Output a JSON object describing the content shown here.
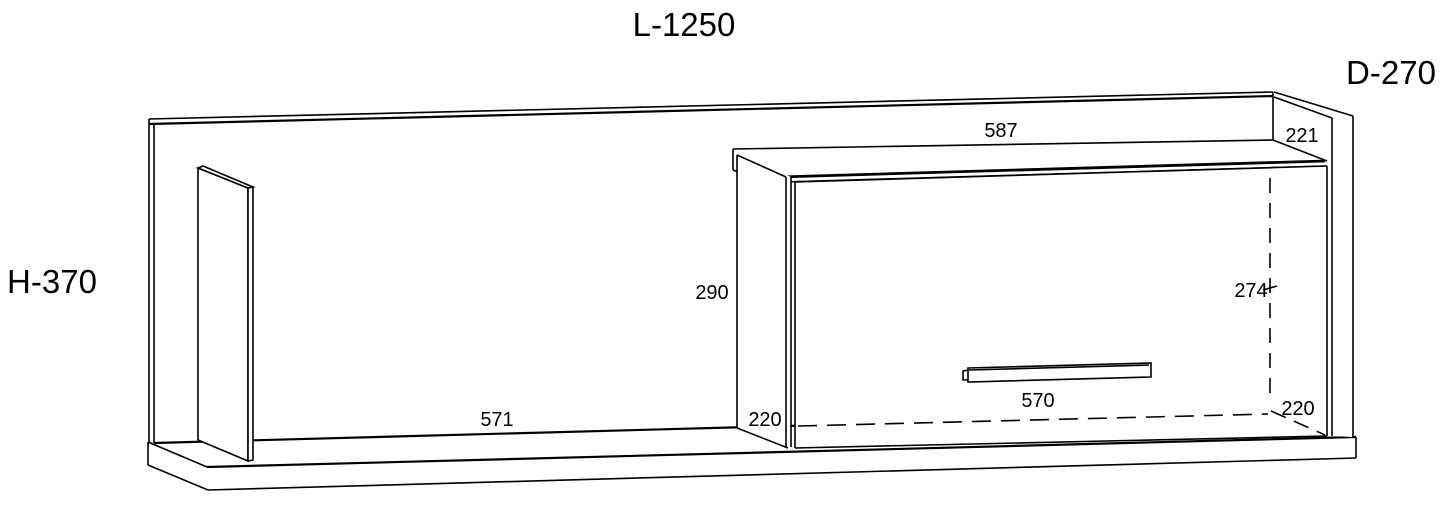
{
  "labels": {
    "length": "L-1250",
    "depth": "D-270",
    "height": "H-370"
  },
  "dimensions": {
    "top_width": "587",
    "top_right_depth": "221",
    "cabinet_side_height": "290",
    "interior_right_height": "274",
    "left_shelf_width": "571",
    "left_bottom_depth": "220",
    "door_handle_width": "570",
    "right_bottom_depth": "220"
  },
  "colors": {
    "line": "#000000",
    "background": "#ffffff"
  }
}
